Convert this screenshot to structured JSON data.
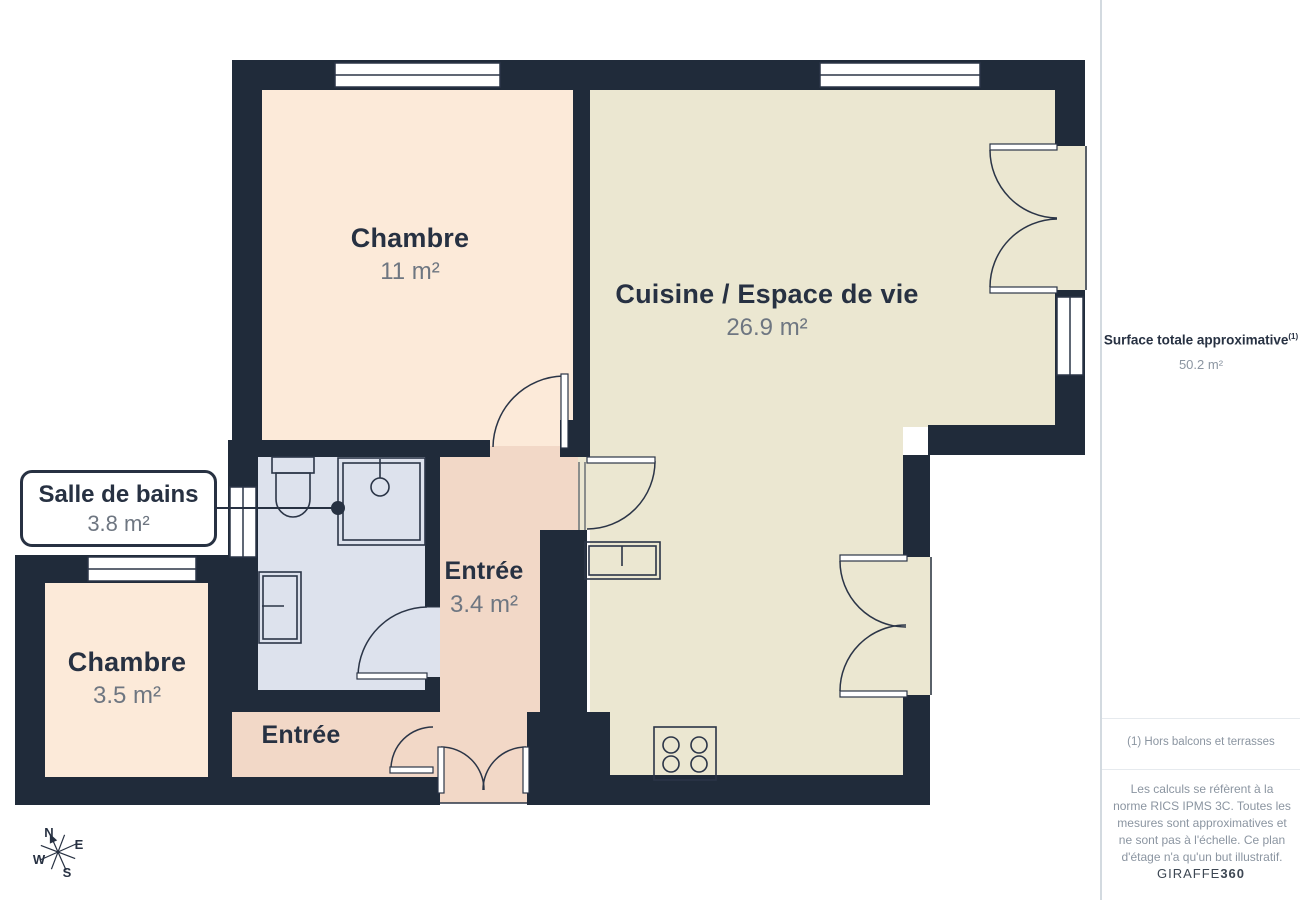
{
  "plan": {
    "rooms": [
      {
        "name": "Chambre",
        "area": "11 m²"
      },
      {
        "name": "Cuisine / Espace de vie",
        "area": "26.9 m²"
      },
      {
        "name": "Entrée",
        "area": "3.4 m²"
      },
      {
        "name": "Chambre",
        "area": "3.5 m²"
      },
      {
        "name": "Entrée",
        "area": ""
      }
    ],
    "callout": {
      "name": "Salle de bains",
      "area": "3.8 m²"
    },
    "compass": {
      "n": "N",
      "e": "E",
      "s": "S",
      "w": "W"
    }
  },
  "sidebar": {
    "title": "Surface totale approximative",
    "title_sup": "(1)",
    "total_area": "50.2 m²",
    "footnote": "(1) Hors balcons et terrasses",
    "disclaimer": "Les calculs se réfèrent à la norme RICS IPMS 3C. Toutes les mesures sont approximatives et ne sont pas à l'échelle. Ce plan d'étage n'a qu'un but illustratif.",
    "brand": "GIRAFFE",
    "brand_bold": "360"
  },
  "colors": {
    "wall": "#202b3a",
    "room_bedroom": "#fcead9",
    "room_living": "#ebe7d1",
    "room_entry": "#f2d8c7",
    "room_bath": "#dde2ed",
    "line": "#2b3547",
    "text_dark": "#273142",
    "text_gray": "#6e7681",
    "sidebar_gray": "#8b95a1",
    "divider": "#e6eaee",
    "border": "#d3dae0",
    "brand": "#3d4753"
  }
}
